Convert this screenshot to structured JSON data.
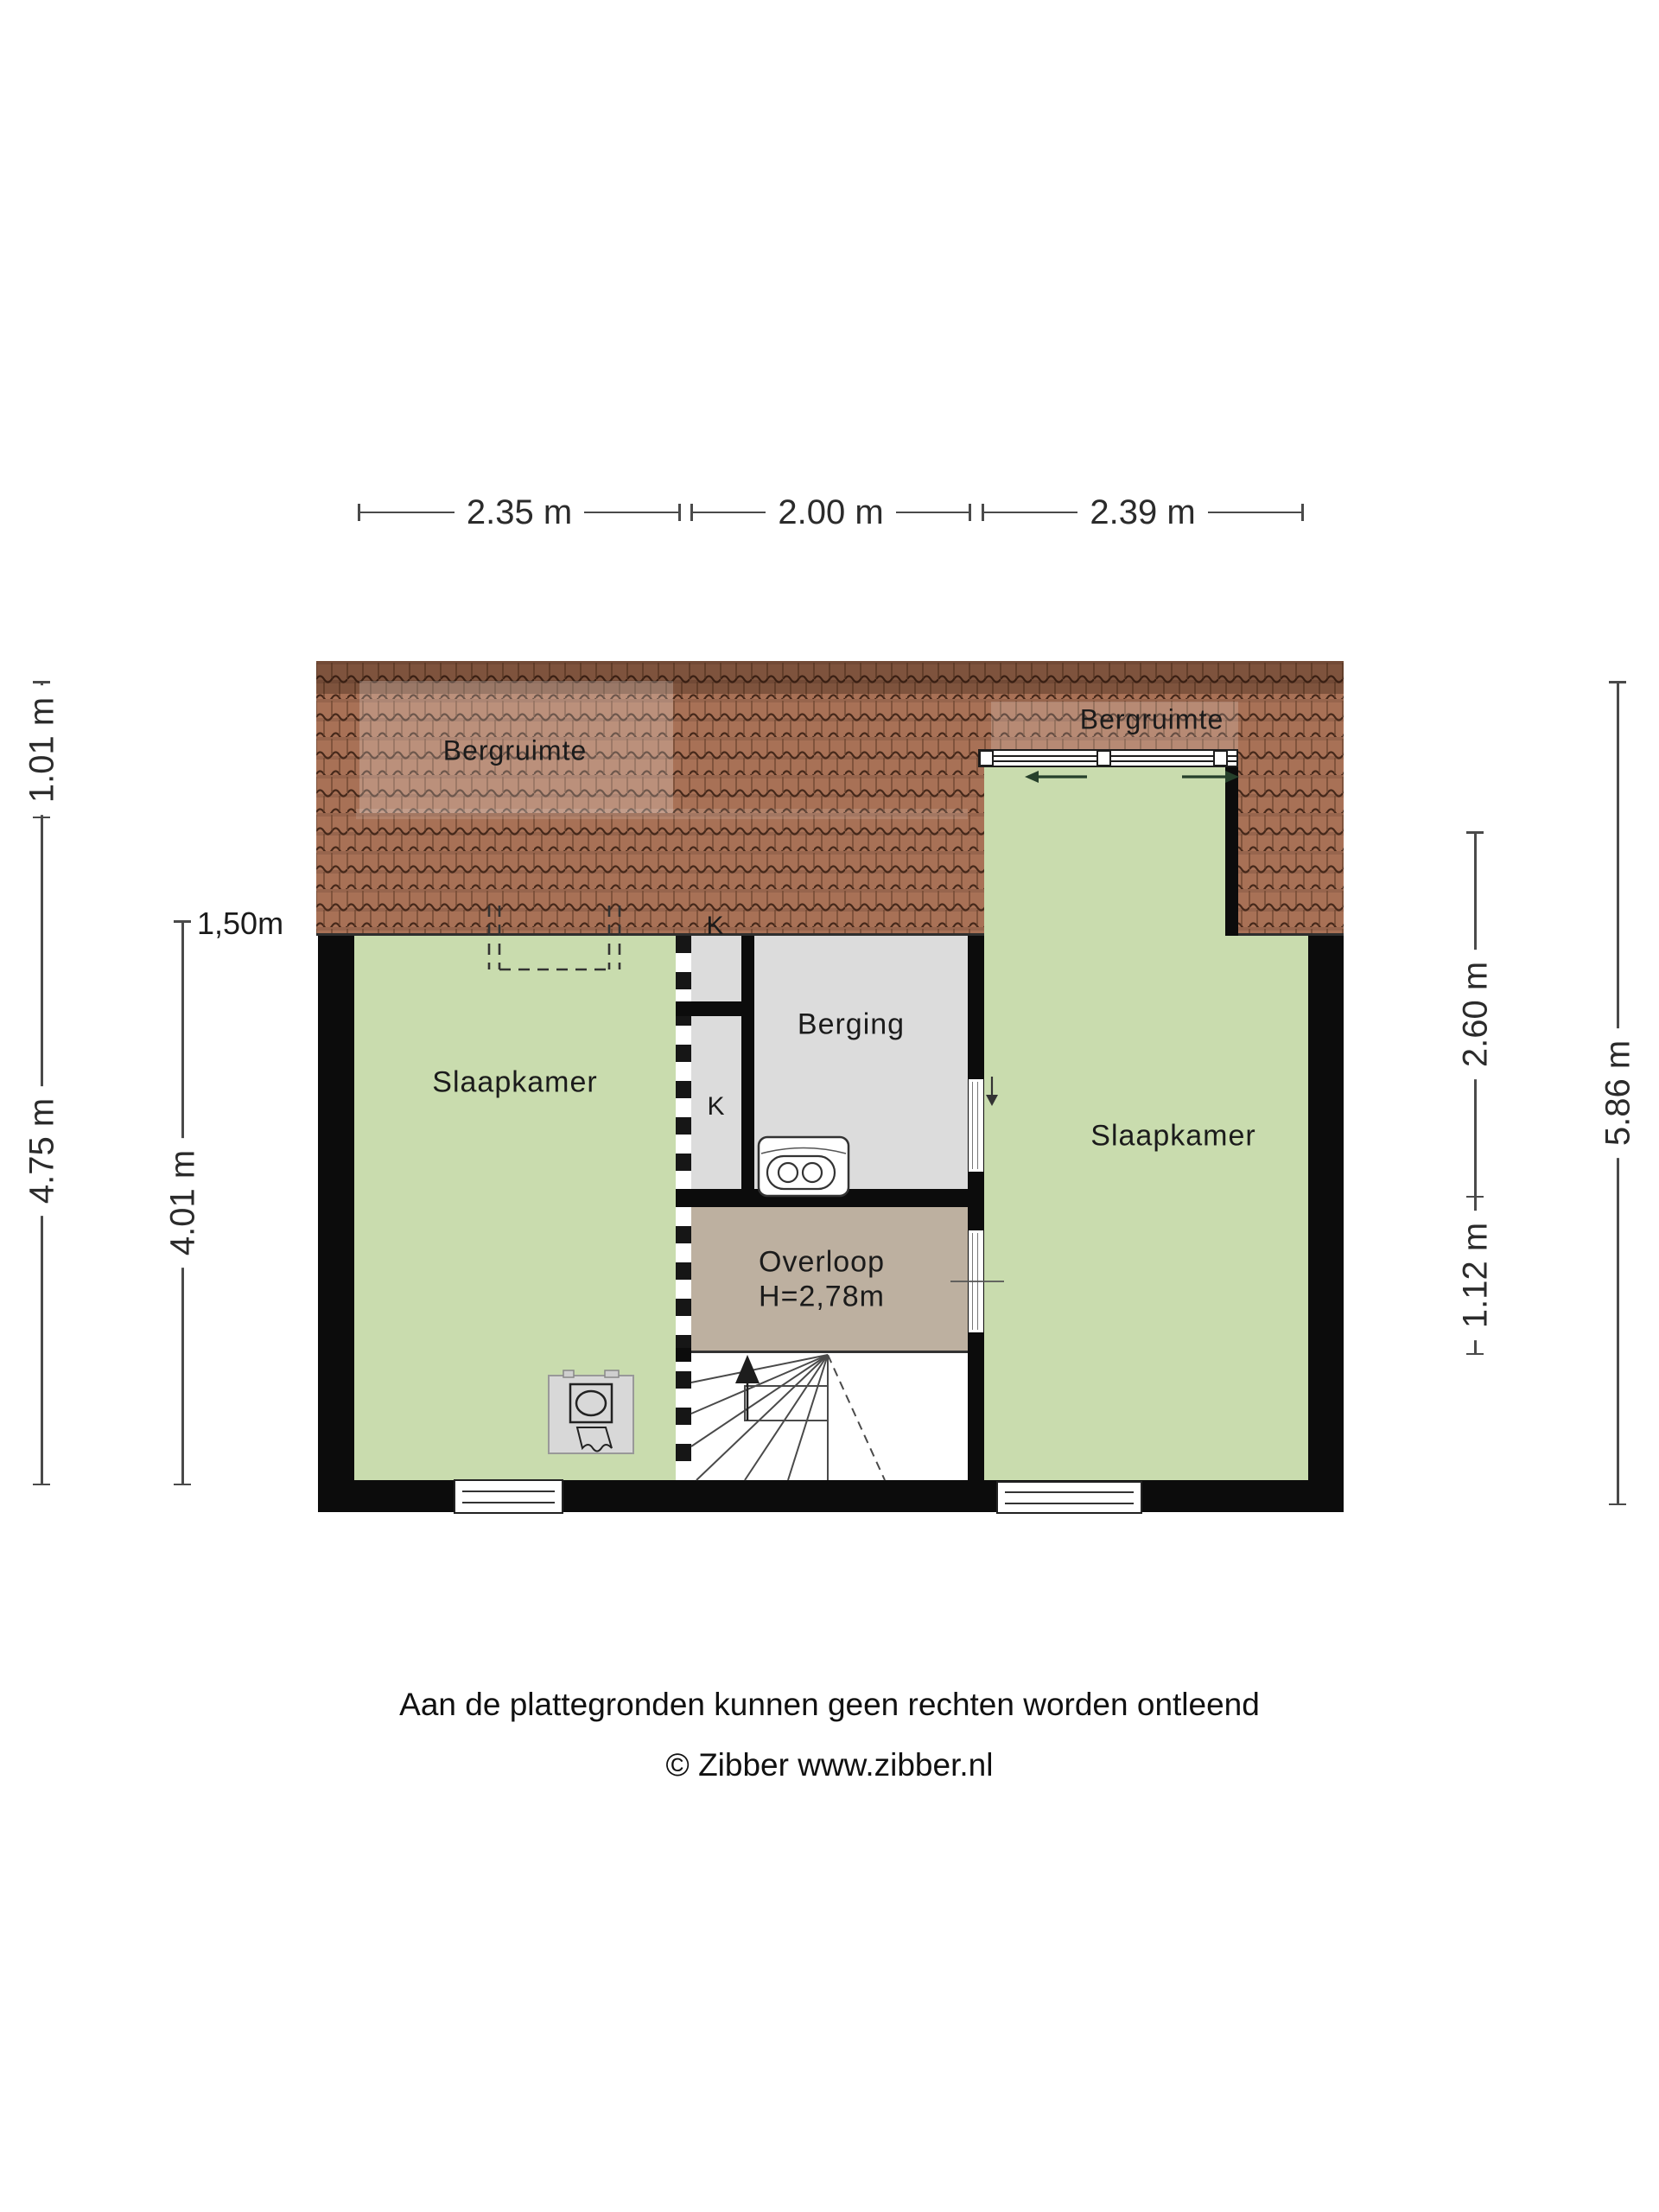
{
  "meta": {
    "type": "floorplan",
    "floor": "attic / second floor"
  },
  "rooms": {
    "bergruimte_left": "Bergruimte",
    "bergruimte_right": "Bergruimte",
    "slaapkamer_left": "Slaapkamer",
    "slaapkamer_right": "Slaapkamer",
    "berging": "Berging",
    "overloop": "Overloop",
    "overloop_height": "H=2,78m",
    "closet_upper": "K",
    "closet_lower": "K"
  },
  "dimensions": {
    "top": [
      "2.35 m",
      "2.00 m",
      "2.39 m"
    ],
    "left": {
      "outer_top": "1.01 m",
      "outer_main": "4.75 m",
      "inner": "4.01 m",
      "marker": "1,50m"
    },
    "right": {
      "upper": "2.60 m",
      "lower": "1.12 m",
      "outer": "5.86 m"
    }
  },
  "footer": {
    "line1": "Aan de plattegronden kunnen geen rechten worden ontleend",
    "line2": "© Zibber www.zibber.nl"
  },
  "icons": {
    "sliding_door_arrows": "left-right",
    "stairs_direction": "up",
    "door_swing_arrow": "down",
    "toilet": "toilet-top-view",
    "washbasin": "washbasin-with-mirror"
  },
  "colors": {
    "room_green": "#c9dcae",
    "room_gray": "#dcdcdc",
    "room_tan": "#bdb0a0",
    "wall": "#0c0c0c",
    "roof_tile": "#a87156",
    "roof_tile_line": "#45281a",
    "dimension_line": "#4a4a4a"
  }
}
